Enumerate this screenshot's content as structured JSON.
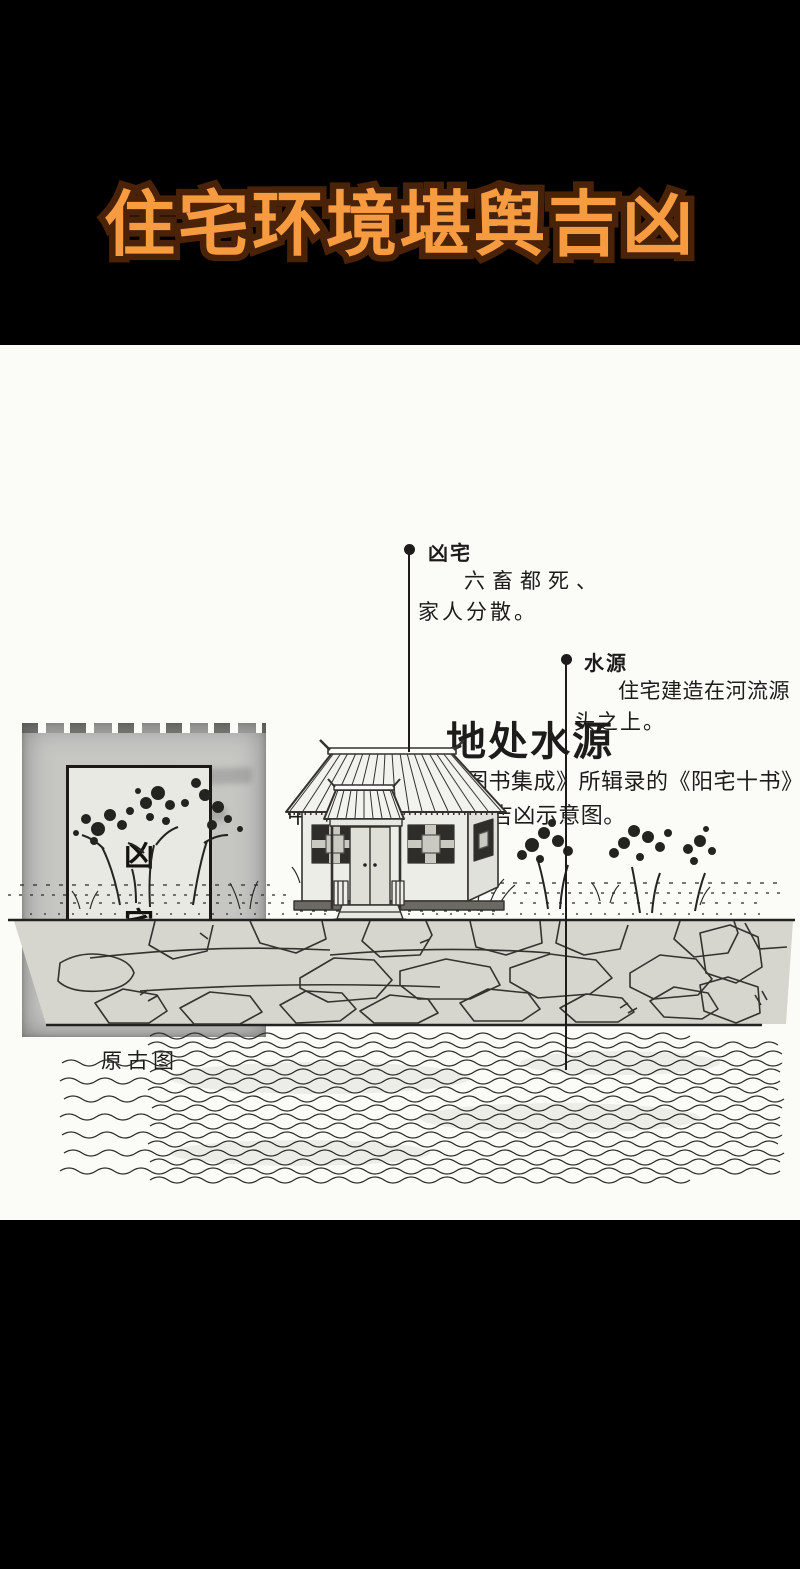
{
  "colors": {
    "accent_orange": "#f79b40",
    "title_outline": "#4a2208",
    "paper": "#fbfbf8",
    "ink": "#1d1c1a"
  },
  "banner": {
    "title": "住宅环境堪舆吉凶"
  },
  "figure": {
    "heading": "地处水源",
    "intro_line1": "此图为《古今图书集成》所辑录的《阳宅十书》",
    "intro_line2": "中关于“地处水源”的吉凶示意图。"
  },
  "ancient_diagram": {
    "chars": [
      "凶",
      "宅"
    ],
    "caption": "原古图"
  },
  "callouts": [
    {
      "label": "凶宅",
      "line1": "六畜都死、",
      "line2": "家人分散。"
    },
    {
      "label": "水源",
      "line1": "住宅建造在河流源",
      "line2": "头之上。"
    }
  ]
}
